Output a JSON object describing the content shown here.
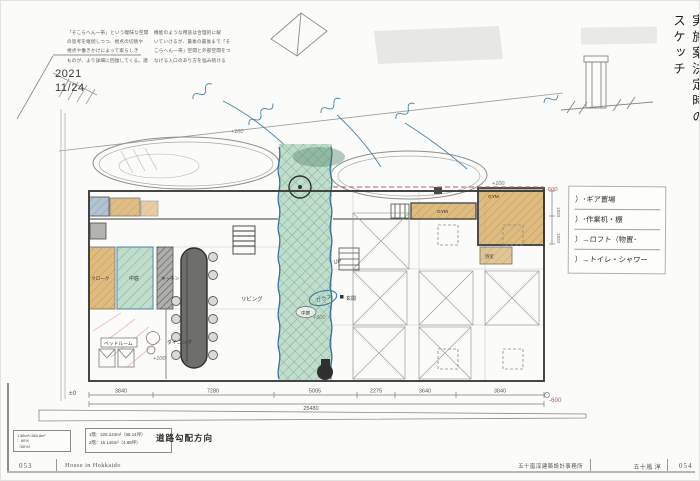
{
  "header": {
    "date_year": "2021",
    "date_day": "11/24",
    "intro_col1_lines": [
      "「そこらへん一帯」という曖昧な空間",
      "の思考を継続しつつ、視点の切替や",
      "視点や働きかけによって家らしき",
      "ものが、より詳細に回復してくる。諸"
    ],
    "intro_col2_lines": [
      "機能のような用途は合理的に解",
      "いていけるが、最後の最後まで「そ",
      "こらへん一帯」空間と外部空間をつ",
      "なげる入口のあり方を悩み続ける"
    ],
    "side_title": "実施案決定時のスケッチ"
  },
  "notes_card": {
    "items": [
      "）･ギア置場",
      "）･作業机・棚",
      "）→ロフト（物置･",
      "）→トイレ・シャワー"
    ]
  },
  "plan": {
    "labels": {
      "cloak": "クローク",
      "courtyard": "中庭",
      "kitchen": "キッチン",
      "bedroom": "ベッドルーム",
      "dining": "ダイニング",
      "living": "リビング",
      "courtyard_small": "中庭",
      "entrance": "玄関",
      "gym": "GYM",
      "bath": "浴室",
      "glass_note": "ガラス",
      "up_note": "UP"
    },
    "levels": {
      "plus100": "+100",
      "zero": "±0",
      "minus600": "-600"
    },
    "dims_bottom": [
      "3840",
      "7280",
      "5005",
      "2275",
      "3640",
      "3840"
    ],
    "dim_total": "25480",
    "dims_right": [
      "1820",
      "1820"
    ]
  },
  "road": {
    "label": "道路勾配方向"
  },
  "info_boxes": {
    "left_lines": [
      "1.88m²=383.8m²",
      "：60%",
      "（50%）"
    ],
    "right_lines": [
      "1階：225.243m²（68.14坪）",
      "2階：16.146m²（4.88坪）"
    ]
  },
  "footer": {
    "page_left": "053",
    "work_title": "House in Hokkaido",
    "firm": "五十嵐淳建築設計事務所",
    "architect": "五十嵐 淳",
    "page_right": "054"
  },
  "colors": {
    "green": "#aed3bc",
    "tan": "#d9b06a",
    "blue_box": "#a8bfce",
    "ink_blue": "#3f7fa0",
    "red": "#c4564a",
    "paper": "#fbfbf9"
  }
}
